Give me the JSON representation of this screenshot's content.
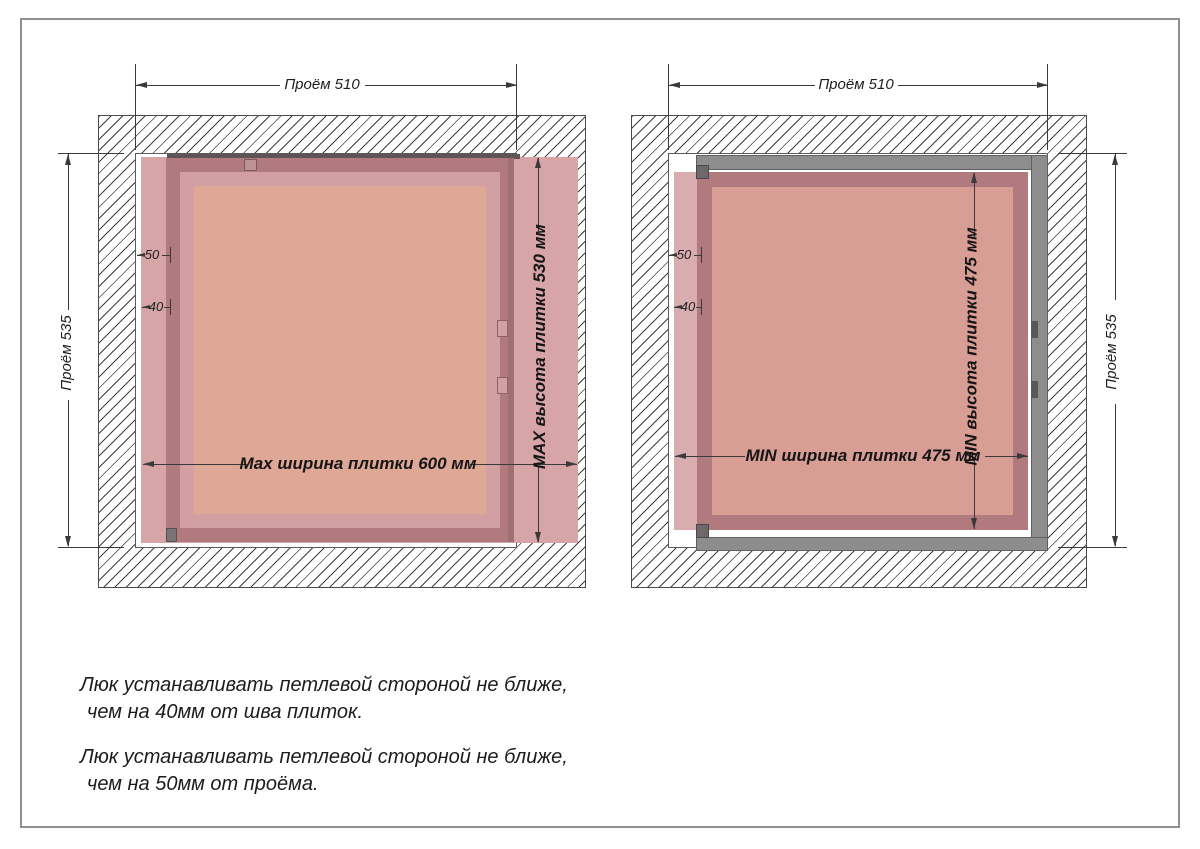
{
  "page": {
    "background": "#ffffff",
    "border_color": "#8f8f8f"
  },
  "colors": {
    "hatch_line": "#3f3f3f",
    "dim_line": "#3a3a3a",
    "tile_pink": "#d7a4a7",
    "tile_light_strip": "#d9acb0",
    "door_frame_mauve": "#b17a7e",
    "inner_light_ring": "#d2a0a3",
    "panel_salmon_max": "#dfa896",
    "panel_salmon_min": "#d89d94",
    "metal_frame_gray": "#8d8d8d",
    "hinge_gray": "#6f686b",
    "top_edge_dark": "#5e5456"
  },
  "diagram_max": {
    "opening_width_label": "Проём 510",
    "opening_height_label": "Проём 535",
    "tile_width_label": "Max ширина плитки 600 мм",
    "tile_height_label": "MAX высота плитки 530 мм",
    "hinge_offset_from_opening": "50",
    "hinge_offset_from_seam": "40"
  },
  "diagram_min": {
    "opening_width_label": "Проём 510",
    "opening_height_label": "Проём 535",
    "tile_width_label": "MIN ширина плитки 475 мм",
    "tile_height_label": "MIN высота плитки 475 мм",
    "hinge_offset_from_opening": "50",
    "hinge_offset_from_seam": "40"
  },
  "notes": [
    {
      "line1": "Люк устанавливать петлевой стороной не ближе,",
      "line2": "чем на 40мм от шва плиток."
    },
    {
      "line1": "Люк устанавливать петлевой стороной не ближе,",
      "line2": "чем на 50мм от проёма."
    }
  ]
}
